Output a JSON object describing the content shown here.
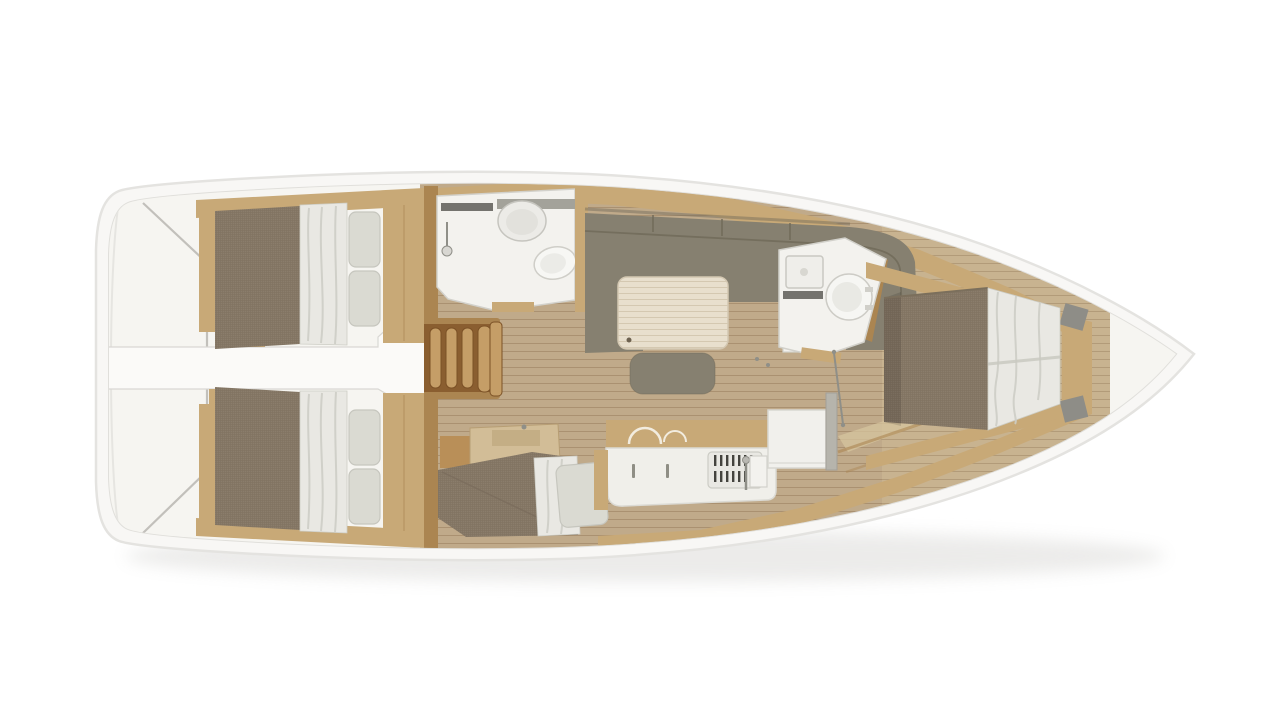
{
  "page": {
    "description": "Top-down 3D rendered interior floor plan of a sailing yacht monohull, bow pointing right, stern at left",
    "background": "#ffffff"
  },
  "colors": {
    "background": "#ffffff",
    "hull_white": "#f8f7f5",
    "hull_edge": "#e4e3e0",
    "hull_inner": "#e0dfdb",
    "deck": "#f6f5f1",
    "corridor": "#fbfaf8",
    "corridor_edge": "#d9d8d4",
    "gray_line": "#b8b6b1",
    "floor": "#c0aa8a",
    "floor_fwd": "#ccb893",
    "plank_line": "#a98f6e",
    "wood": "#c8a977",
    "wood_dark": "#ab8551",
    "wood_seam": "#b2905e",
    "stairs_base": "#8a5e30",
    "stairs_tread": "#c59e67",
    "stairs_edge": "#7b5126",
    "mattress": "#8b7d6b",
    "mattress_dark": "#7a6d5c",
    "sofa": "#868070",
    "sofa_dark": "#6f6959",
    "table": "#e8dfcd",
    "duvet": "#e9e8e3",
    "duvet_fold": "#cdcdc5",
    "pillow": "#dadad2",
    "pillow_edge": "#c6c6be",
    "fixture": "#f3f2ee",
    "fixture_edge": "#d2d1cb",
    "steel": "#8f8f88",
    "grill": "#44433e",
    "dark_slot": "#54534e"
  },
  "floorplan": {
    "vessel": "sailing-yacht-monohull",
    "view": "top-down-interior-render",
    "orientation": {
      "bow": "right",
      "stern": "left"
    },
    "rooms": [
      {
        "id": "transom",
        "name": "Stern swim platform and transom walkway",
        "features": [
          "white deck",
          "hull chine lines"
        ]
      },
      {
        "id": "aft-cabin-port",
        "name": "Aft double cabin (port)",
        "features": [
          "double berth",
          "brown mattress",
          "white duvet",
          "two pillows",
          "wood lockers"
        ]
      },
      {
        "id": "aft-cabin-starboard",
        "name": "Aft double cabin (starboard)",
        "features": [
          "double berth",
          "brown mattress",
          "white duvet",
          "two pillows",
          "wood lockers"
        ]
      },
      {
        "id": "corridor",
        "name": "Central walkway between aft cabins",
        "features": [
          "white sole",
          "wood trim steps"
        ]
      },
      {
        "id": "companionway",
        "name": "Companionway stairs",
        "features": [
          "four wooden treads",
          "side rails"
        ]
      },
      {
        "id": "aft-head",
        "name": "Aft head with shower",
        "features": [
          "round washbasin",
          "toilet",
          "hand shower"
        ]
      },
      {
        "id": "salon",
        "name": "Salon",
        "features": [
          "U-shaped olive sofa",
          "folding table",
          "ottoman bench",
          "side cabinet"
        ]
      },
      {
        "id": "galley",
        "name": "Galley",
        "features": [
          "worktop",
          "twin sinks",
          "faucet",
          "stove with grill",
          "fridge module"
        ]
      },
      {
        "id": "mid-berth",
        "name": "Mid single berth with vanity",
        "features": [
          "single mattress",
          "duvet",
          "pillow",
          "wood vanity desk"
        ]
      },
      {
        "id": "forward-head",
        "name": "Forward head",
        "features": [
          "square washbasin",
          "round toilet"
        ]
      },
      {
        "id": "forward-cabin",
        "name": "Forward island-berth cabin",
        "features": [
          "island double bed",
          "brown foot cushion",
          "white duvet",
          "wood platform rails"
        ]
      },
      {
        "id": "bow",
        "name": "Bow peak",
        "features": [
          "pointed hull",
          "anchor locker area"
        ]
      }
    ]
  }
}
